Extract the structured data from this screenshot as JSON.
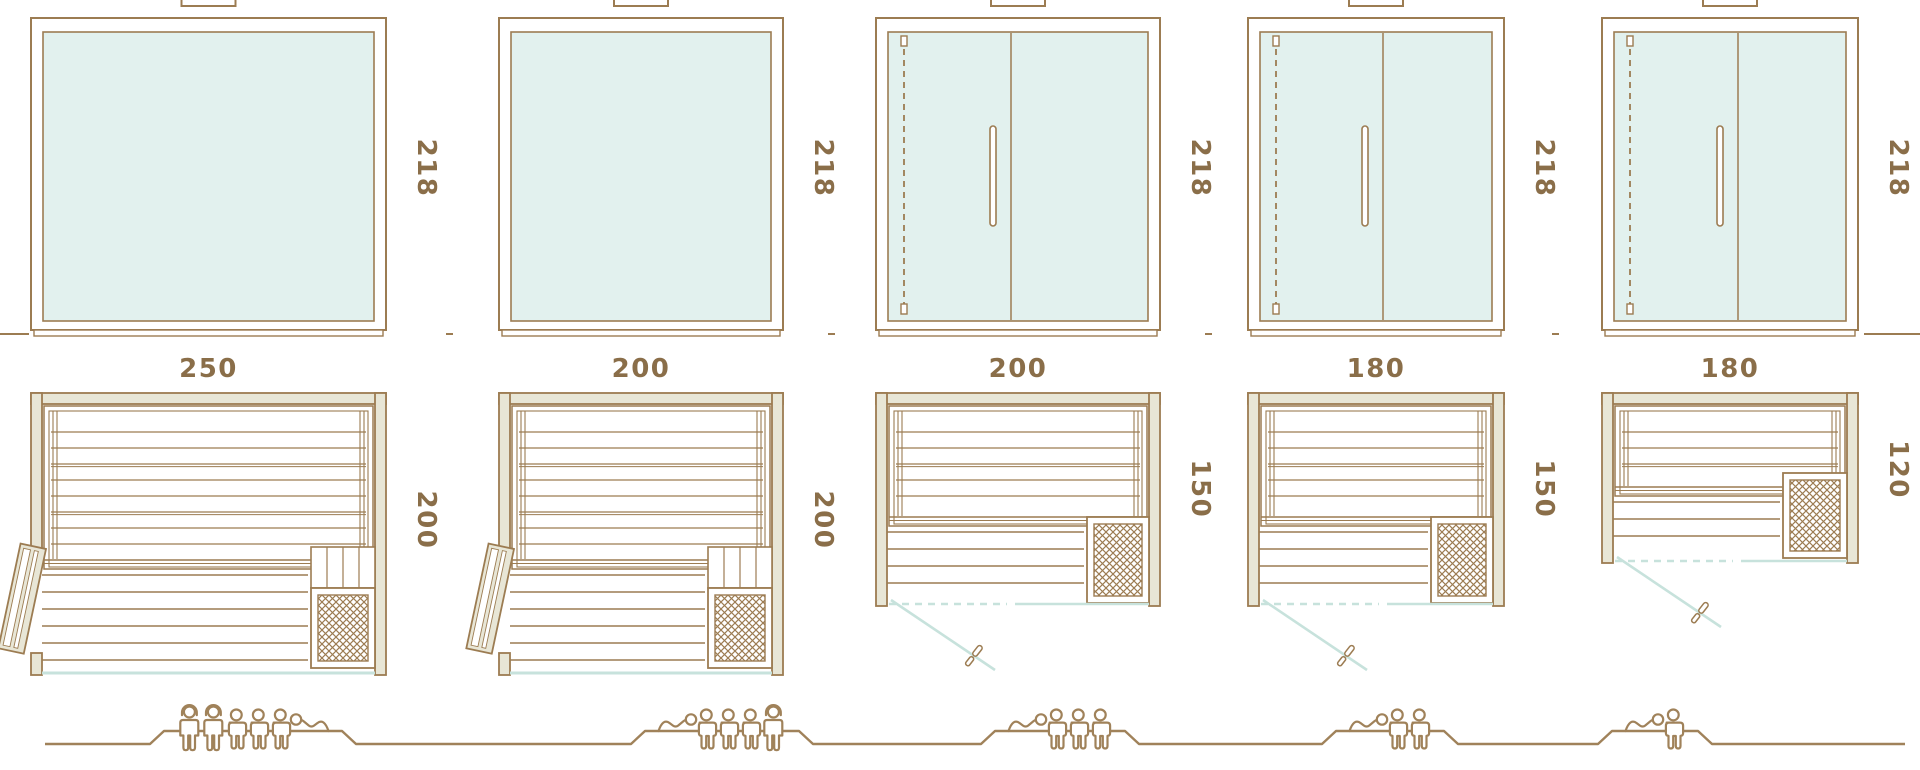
{
  "colors": {
    "line": "#9c7c52",
    "line_strong": "#8f7450",
    "label_text": "#8a6e49",
    "wall_fill": "#e8e6d6",
    "glass_fill": "#e2f1ee",
    "glass_line": "#c7e2dc",
    "background": "#ffffff"
  },
  "units": [
    {
      "id": "variant-1",
      "labels": {
        "width": "250",
        "depth": "200",
        "height": "218"
      },
      "width_cm": 250,
      "depth_cm": 200,
      "height_cm": 218,
      "elevation_type": "fixed-glass-panel",
      "plan": {
        "door": "side-hinged-timber-door",
        "heater": "front-right",
        "front": "glass",
        "step": true
      },
      "capacity": {
        "total": 6,
        "figures": [
          "standing",
          "standing",
          "sitting",
          "sitting",
          "sitting",
          "lying"
        ]
      }
    },
    {
      "id": "variant-2",
      "labels": {
        "width": "200",
        "depth": "200",
        "height": "218"
      },
      "width_cm": 200,
      "depth_cm": 200,
      "height_cm": 218,
      "elevation_type": "fixed-glass-panel",
      "plan": {
        "door": "side-hinged-timber-door",
        "heater": "front-right",
        "front": "glass",
        "step": true
      },
      "capacity": {
        "total": 5,
        "figures": [
          "lying",
          "sitting",
          "sitting",
          "sitting",
          "standing"
        ]
      }
    },
    {
      "id": "variant-3",
      "labels": {
        "width": "200",
        "depth": "150",
        "height": "218"
      },
      "width_cm": 200,
      "depth_cm": 150,
      "height_cm": 218,
      "elevation_type": "hinged-glass-door",
      "plan": {
        "door": "front-glass-door",
        "heater": "front-right",
        "front": "glass",
        "step": false
      },
      "capacity": {
        "total": 4,
        "figures": [
          "lying",
          "sitting",
          "sitting",
          "sitting"
        ]
      }
    },
    {
      "id": "variant-4",
      "labels": {
        "width": "180",
        "depth": "150",
        "height": "218"
      },
      "width_cm": 180,
      "depth_cm": 150,
      "height_cm": 218,
      "elevation_type": "hinged-glass-door",
      "plan": {
        "door": "front-glass-door",
        "heater": "front-right",
        "front": "glass",
        "step": false
      },
      "capacity": {
        "total": 3,
        "figures": [
          "lying",
          "sitting",
          "sitting"
        ]
      }
    },
    {
      "id": "variant-5",
      "labels": {
        "width": "180",
        "depth": "120",
        "height": "218"
      },
      "width_cm": 180,
      "depth_cm": 120,
      "height_cm": 218,
      "elevation_type": "hinged-glass-door",
      "plan": {
        "door": "front-glass-door",
        "heater": "front-right",
        "front": "glass",
        "step": false
      },
      "capacity": {
        "total": 2,
        "figures": [
          "lying",
          "sitting"
        ]
      }
    }
  ]
}
